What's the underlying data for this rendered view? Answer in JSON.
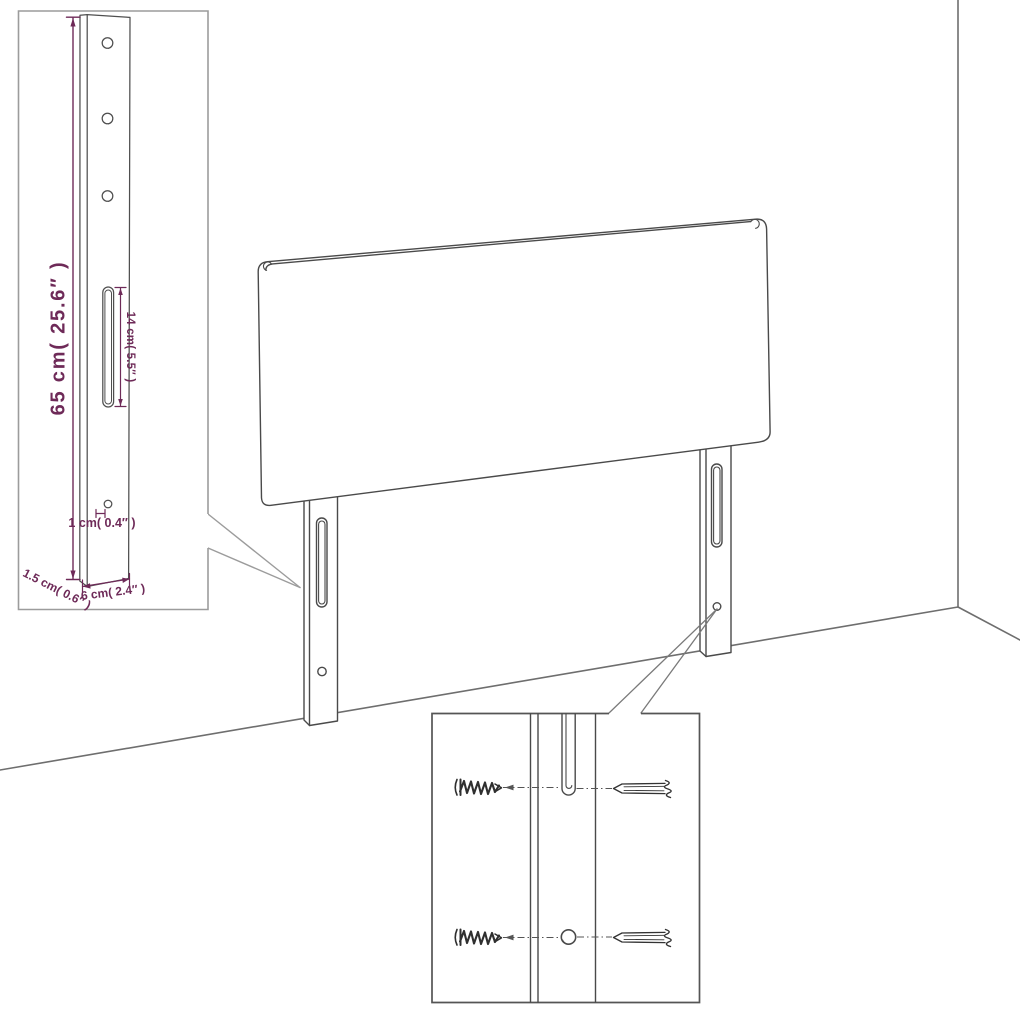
{
  "dimension_labels": {
    "post_height": "65 cm( 25.6″ )",
    "slot_length": "14 cm( 5.5″ )",
    "hole_diameter": "1 cm( 0.4″ )",
    "post_thickness": "1.5 cm( 0.6″ )",
    "post_width": "6 cm( 2.4″ )"
  },
  "colors": {
    "dimension_text": "#6e2a58",
    "drawing_line": "#4a4a4a",
    "detail_inset_border": "#9c9c9c",
    "hardware_inset_border": "#555555",
    "wall_line": "#6e6e6e",
    "background": "#ffffff"
  }
}
